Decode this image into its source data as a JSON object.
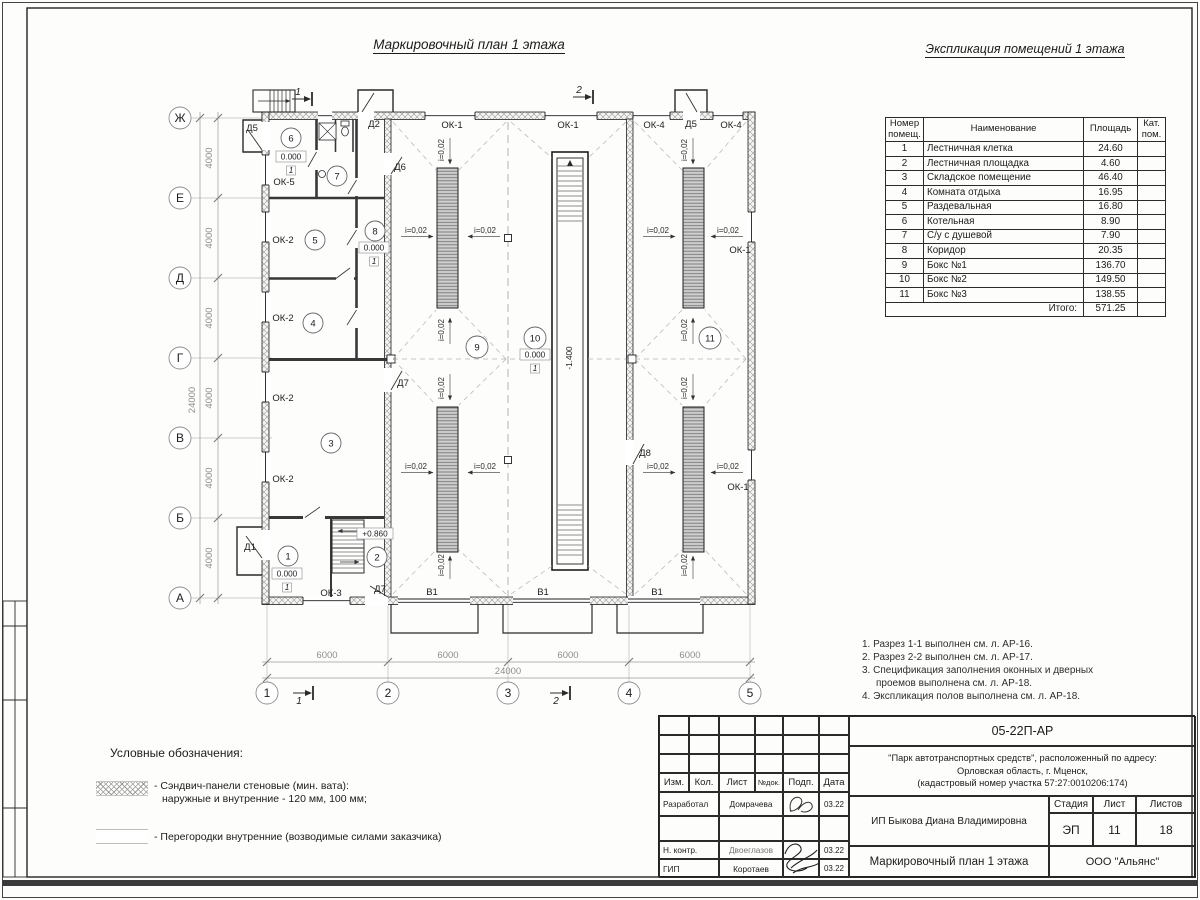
{
  "plan": {
    "title": "Маркировочный план 1 этажа",
    "axes": {
      "rows": [
        "Ж",
        "Е",
        "Д",
        "Г",
        "В",
        "Б",
        "А"
      ],
      "cols": [
        "1",
        "2",
        "3",
        "4",
        "5"
      ]
    },
    "dims": {
      "bay_v": "4000",
      "total_v": "24000",
      "bay_h": "6000",
      "total_h": "24000"
    },
    "rooms": [
      "1",
      "2",
      "3",
      "4",
      "5",
      "6",
      "7",
      "8",
      "9",
      "10",
      "11"
    ],
    "marks": {
      "ok1": "ОК-1",
      "ok2": "ОК-2",
      "ok3": "ОК-3",
      "ok4": "ОК-4",
      "ok5": "ОК-5",
      "d1": "Д1",
      "d2": "Д2",
      "d5": "Д5",
      "d6": "Д6",
      "d7": "Д7",
      "d8": "Д8",
      "v1": "В1"
    },
    "levels": {
      "zero": "0.000",
      "stair": "+0.860",
      "pit": "-1.400"
    },
    "slope": "i=0,02",
    "floor_mark": "1",
    "sections": {
      "s1": "1",
      "s2": "2"
    }
  },
  "explication": {
    "title": "Экспликация помещений 1 этажа",
    "headers": {
      "num": "Номер помещ.",
      "name": "Наименование",
      "area": "Площадь",
      "cat": "Кат. пом."
    },
    "rows": [
      {
        "num": "1",
        "name": "Лестничная клетка",
        "area": "24.60"
      },
      {
        "num": "2",
        "name": "Лестничная площадка",
        "area": "4.60"
      },
      {
        "num": "3",
        "name": "Складское помещение",
        "area": "46.40"
      },
      {
        "num": "4",
        "name": "Комната отдыха",
        "area": "16.95"
      },
      {
        "num": "5",
        "name": "Раздевальная",
        "area": "16.80"
      },
      {
        "num": "6",
        "name": "Котельная",
        "area": "8.90"
      },
      {
        "num": "7",
        "name": "С/у с душевой",
        "area": "7.90"
      },
      {
        "num": "8",
        "name": "Коридор",
        "area": "20.35"
      },
      {
        "num": "9",
        "name": "Бокс №1",
        "area": "136.70"
      },
      {
        "num": "10",
        "name": "Бокс №2",
        "area": "149.50"
      },
      {
        "num": "11",
        "name": "Бокс №3",
        "area": "138.55"
      }
    ],
    "total_label": "Итого:",
    "total_value": "571.25"
  },
  "notes": {
    "items": [
      "1. Разрез 1-1 выполнен см. л. АР-16.",
      "2. Разрез 2-2 выполнен см. л. АР-17.",
      "3. Спецификация заполнения оконных и дверных проемов выполнена см. л. АР-18.",
      "4. Экспликация полов выполнена см. л. АР-18."
    ]
  },
  "legend": {
    "title": "Условные обозначения:",
    "item1_line1": "- Сэндвич-панели стеновые (мин. вата):",
    "item1_line2": "наружные и внутренние - 120 мм, 100 мм;",
    "item2": "- Перегородки внутренние (возводимые силами заказчика)"
  },
  "titleblock": {
    "doc_code": "05-22П-АР",
    "project_line1": "\"Парк автотранспортных средств\",  расположенный по адресу:",
    "project_line2": "Орловская область, г. Мценск,",
    "project_line3": "(кадастровый номер участка 57:27:0010206:174)",
    "cols": {
      "izm": "Изм.",
      "kol": "Кол.",
      "list": "Лист",
      "ndok": "№док.",
      "podp": "Подп.",
      "data": "Дата"
    },
    "rows": [
      {
        "role": "Разработал",
        "name": "Домрачева",
        "date": "03.22"
      },
      {
        "role": "Н. контр.",
        "name": "Двоеглазов",
        "date": "03.22"
      },
      {
        "role": "ГИП",
        "name": "Коротаев",
        "date": "03.22"
      }
    ],
    "client": "ИП Быкова Диана Владимировна",
    "stage_label": "Стадия",
    "sheet_label": "Лист",
    "sheets_label": "Листов",
    "stage": "ЭП",
    "sheet": "11",
    "sheets": "18",
    "sheet_title": "Маркировочный план 1 этажа",
    "company": "ООО \"Альянс\""
  }
}
